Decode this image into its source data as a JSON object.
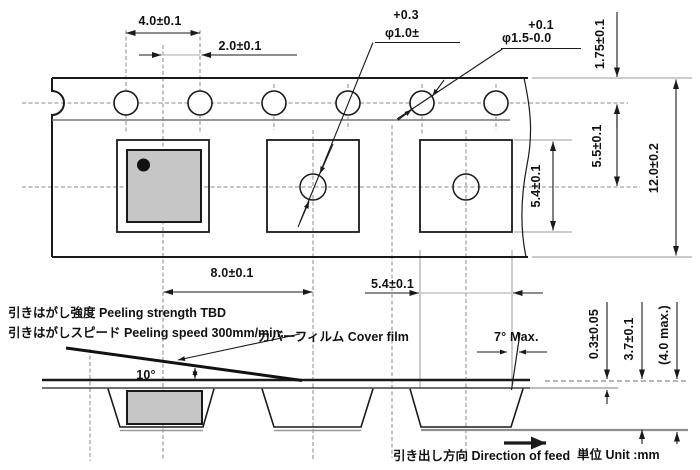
{
  "drawing_title": "carrier-tape-dimension-drawing",
  "colors": {
    "line": "#1a1a1a",
    "gray": "#909090",
    "component_fill": "#c6c6c6",
    "background": "#ffffff"
  },
  "labels": {
    "dim_pitch": "4.0±0.1",
    "dim_offset": "2.0±0.1",
    "tol_small": "+0.3",
    "dia_small": "φ1.0±",
    "tol_sprocket": "+0.1",
    "dia_sprocket": "φ1.5-0.0",
    "dim_edge": "1.75±0.1",
    "dim_center": "5.5±0.1",
    "dim_pocket_len": "5.4±0.1",
    "dim_width": "12.0±0.2",
    "dim_pocket_pitch": "8.0±0.1",
    "dim_pocket_w": "5.4±0.1",
    "angle_wall": "7° Max.",
    "angle_peel": "10°",
    "dim_thickness": "0.3±0.05",
    "dim_depth": "3.7±0.1",
    "dim_depth_max": "(4.0 max.)",
    "note_strength": "引きはがし強度 Peeling strength TBD",
    "note_speed": "引きはがしスピード Peeling speed 300mm/min.",
    "note_cover": "カバーフィルム Cover film",
    "note_feed": "引き出し方向 Direction of feed",
    "note_unit": "単位 Unit :mm"
  }
}
